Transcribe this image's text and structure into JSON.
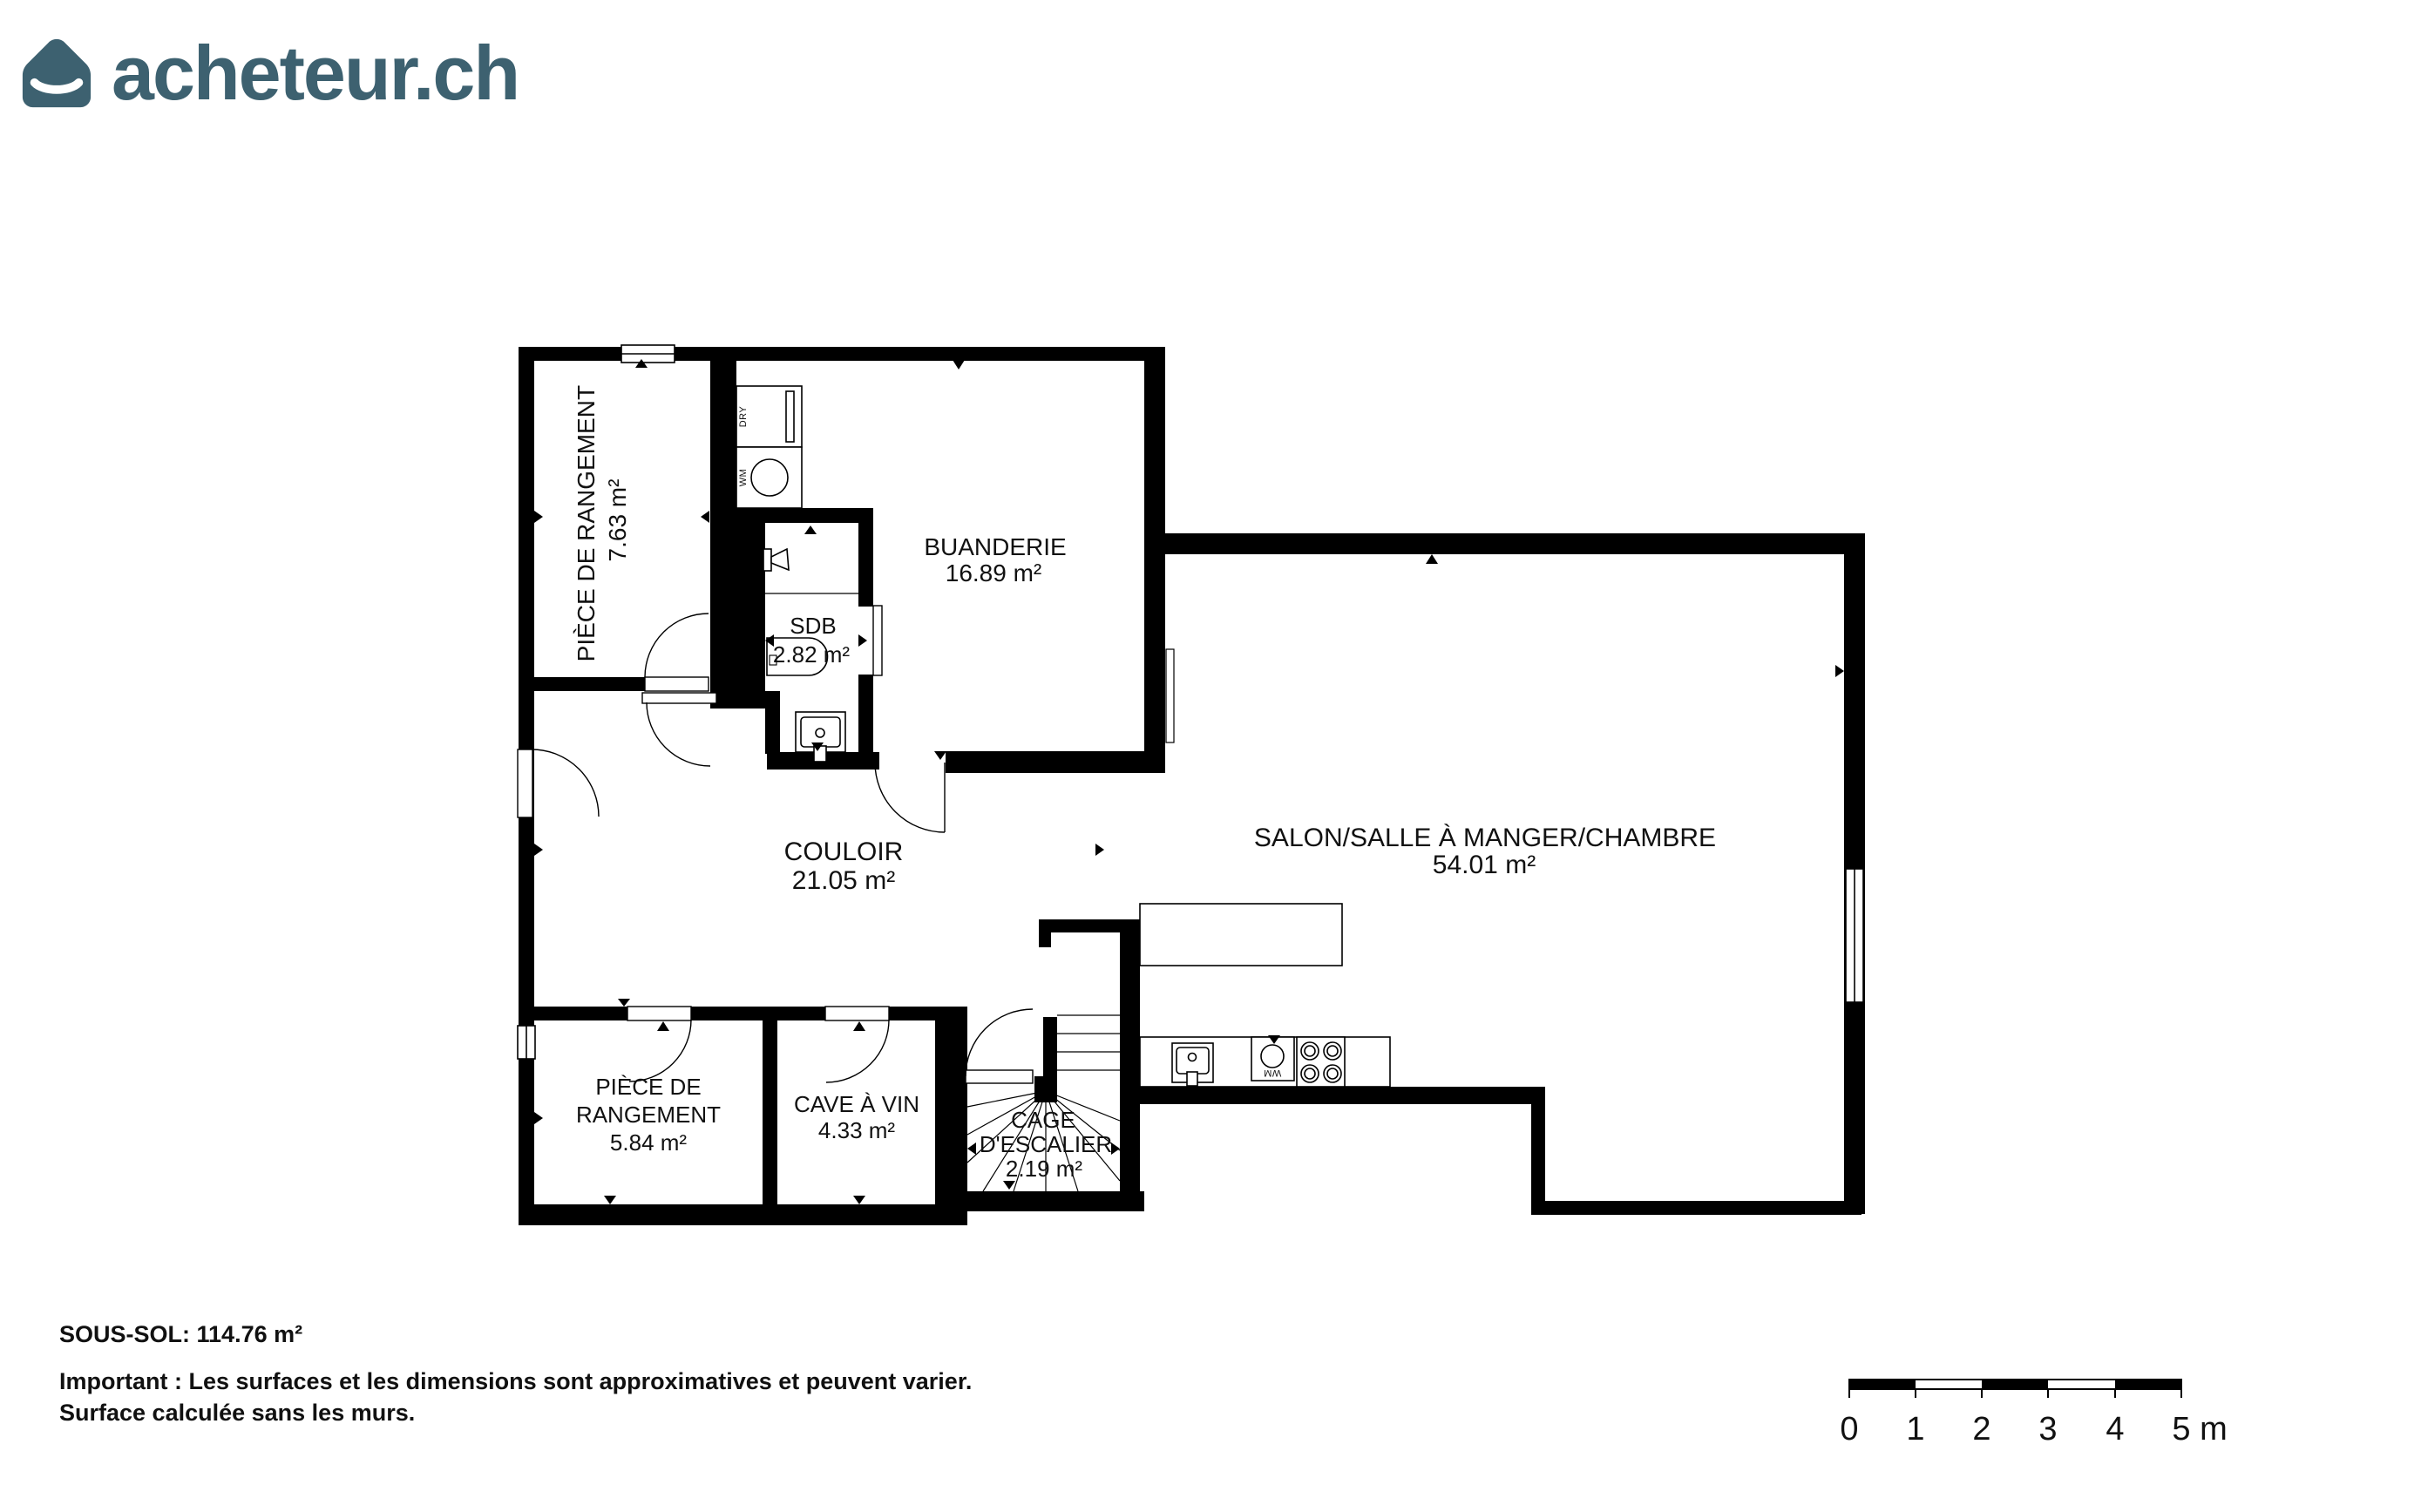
{
  "logo": {
    "text": "acheteur.ch",
    "color": "#3d6170"
  },
  "floor_plan": {
    "rooms": [
      {
        "id": "storage-top",
        "name": "PIÈCE DE RANGEMENT",
        "area": "7.63 m²"
      },
      {
        "id": "laundry",
        "name": "BUANDERIE",
        "area": "16.89 m²"
      },
      {
        "id": "bathroom",
        "name": "SDB",
        "area": "2.82 m²"
      },
      {
        "id": "hallway",
        "name": "COULOIR",
        "area": "21.05 m²"
      },
      {
        "id": "living",
        "name": "SALON/SALLE À MANGER/CHAMBRE",
        "area": "54.01 m²"
      },
      {
        "id": "storage-bottom",
        "name_line1": "PIÈCE DE",
        "name_line2": "RANGEMENT",
        "area": "5.84 m²"
      },
      {
        "id": "wine-cellar",
        "name": "CAVE À VIN",
        "area": "4.33 m²"
      },
      {
        "id": "staircase",
        "name_line1": "CAGE",
        "name_line2": "D'ESCALIER",
        "area": "2.19 m²"
      }
    ],
    "appliances": {
      "dryer": "DRY",
      "washer": "WM",
      "kitchen_washer": "WM"
    }
  },
  "footer": {
    "title": "SOUS-SOL: 114.76 m²",
    "note_line1": "Important : Les surfaces et les dimensions sont approximatives et peuvent varier.",
    "note_line2": "Surface calculée sans les murs."
  },
  "scale_bar": {
    "labels": [
      "0",
      "1",
      "2",
      "3",
      "4",
      "5"
    ],
    "unit": "m"
  }
}
